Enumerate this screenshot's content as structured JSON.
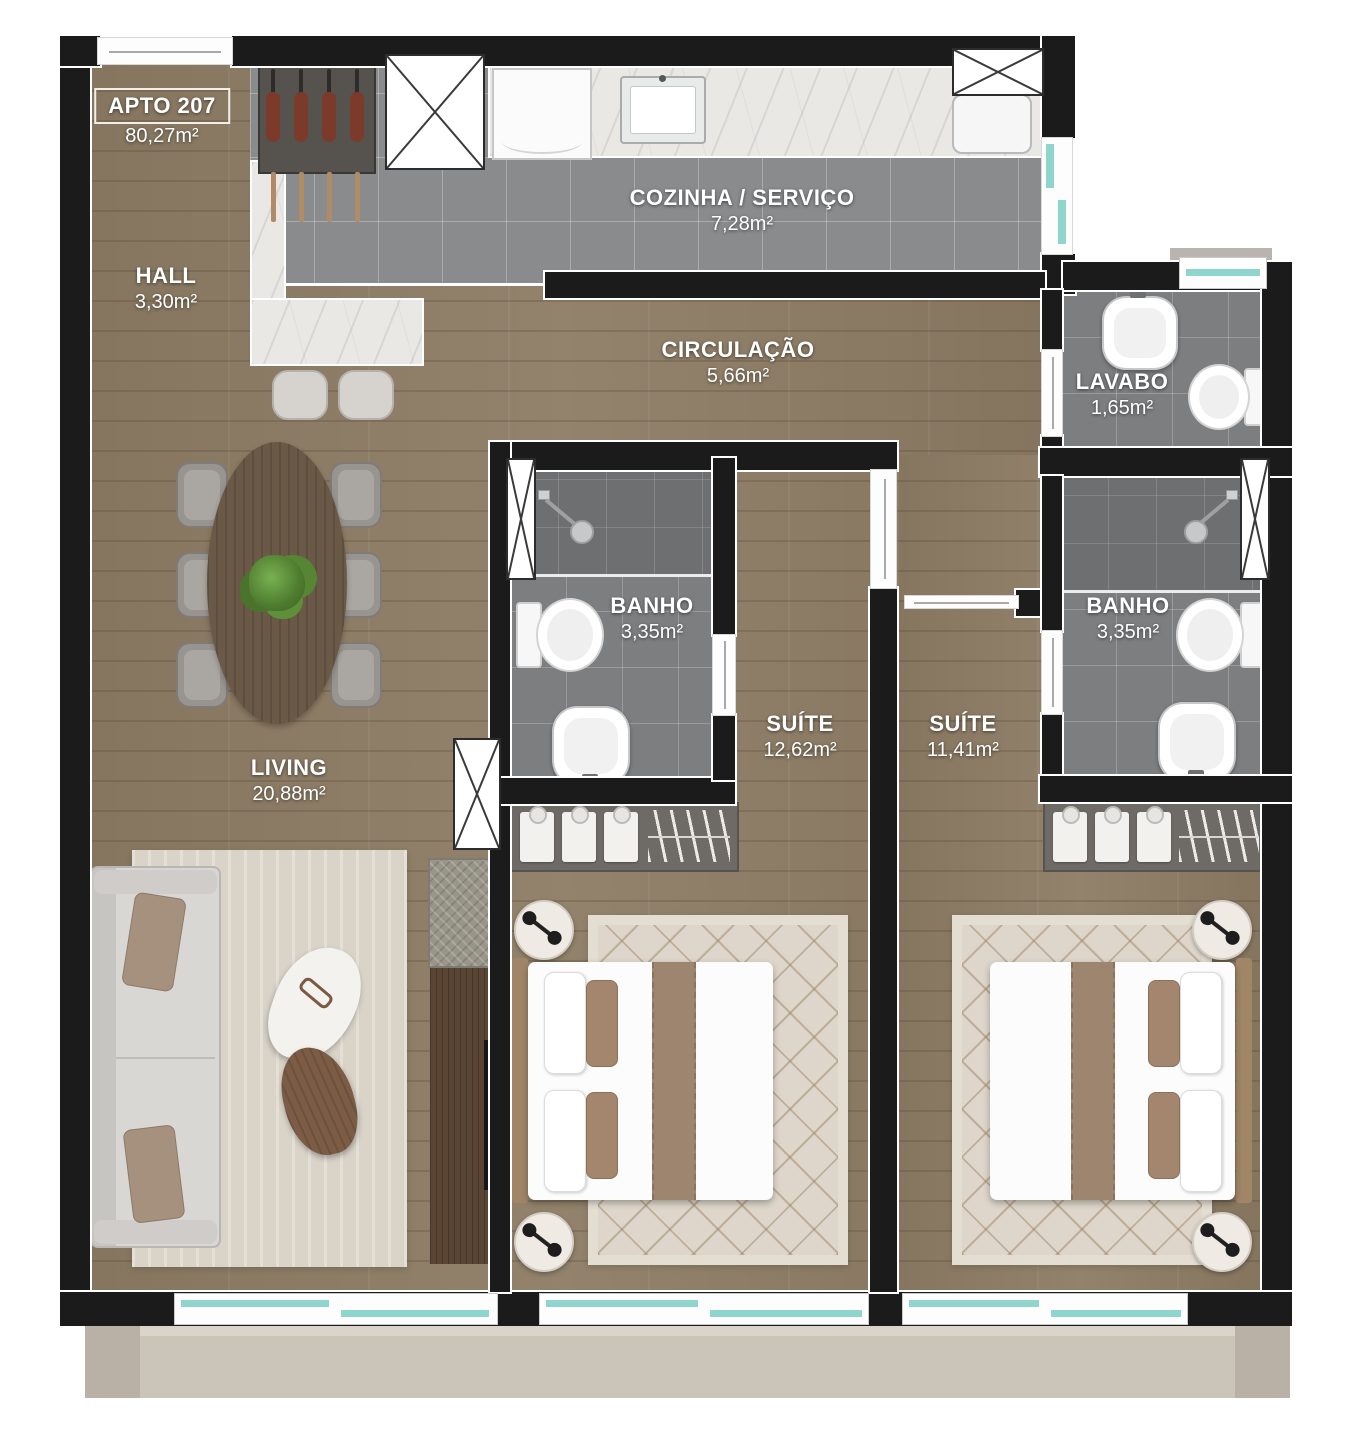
{
  "unit": {
    "name": "APTO 207",
    "area": "80,27m²"
  },
  "rooms": {
    "hall": {
      "name": "HALL",
      "area": "3,30m²"
    },
    "cozinha": {
      "name": "COZINHA / SERVIÇO",
      "area": "7,28m²"
    },
    "circulacao": {
      "name": "CIRCULAÇÃO",
      "area": "5,66m²"
    },
    "lavabo": {
      "name": "LAVABO",
      "area": "1,65m²"
    },
    "banho_suite_1": {
      "name": "BANHO",
      "area": "3,35m²"
    },
    "suite_1": {
      "name": "SUÍTE",
      "area": "12,62m²"
    },
    "suite_2": {
      "name": "SUÍTE",
      "area": "11,41m²"
    },
    "banho_suite_2": {
      "name": "BANHO",
      "area": "3,35m²"
    },
    "living": {
      "name": "LIVING",
      "area": "20,88m²"
    }
  },
  "colors": {
    "wall": "#1b1b1b",
    "wood_floor": "#8d7c64",
    "kitchen_tile": "#8a8b8d",
    "bath_tile": "#7d7e80",
    "marble_counter": "#eae8e4",
    "window_glass": "#8ed5cd",
    "rug": "#ded6ca",
    "balcony_slab": "#cbc4b8",
    "label_text": "#ffffff"
  }
}
